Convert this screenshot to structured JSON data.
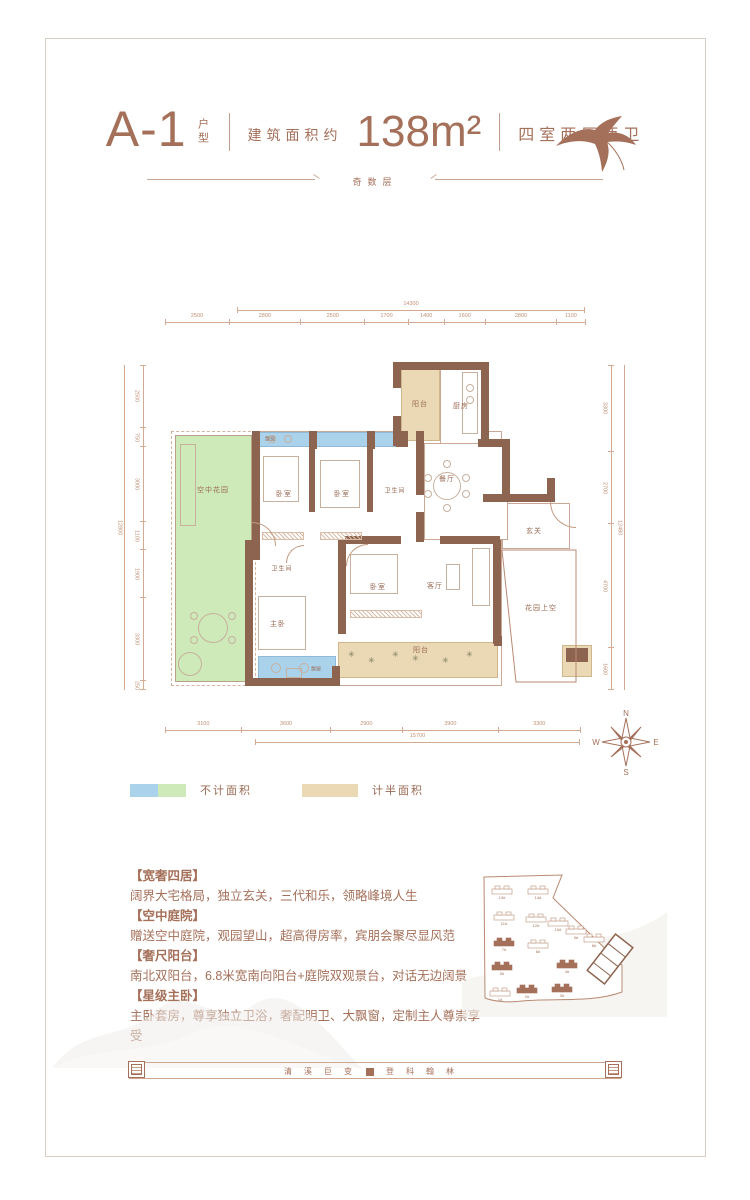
{
  "header": {
    "unit": "A-1",
    "unit_suffix": "户型",
    "area_prefix": "建筑面积约",
    "area": "138m²",
    "layout": "四室两厅两卫",
    "floor_note": "奇数层"
  },
  "floorplan": {
    "rooms": {
      "balcony_top": "阳台",
      "kitchen": "厨房",
      "bedroom_a": "卧室",
      "bedroom_b": "卧室",
      "bath_a": "卫生间",
      "dining": "餐厅",
      "foyer": "玄关",
      "living": "客厅",
      "bedroom_c": "卧室",
      "bath_b": "卫生间",
      "master": "主卧",
      "sky_garden": "空中花园",
      "garden_void": "花园上空",
      "balcony_bottom": "阳台",
      "bay_window_top": "飘窗",
      "bay_window_bottom": "飘窗"
    },
    "dims": {
      "top": {
        "total": "14300",
        "segments": [
          "2500",
          "2800",
          "2500",
          "1700",
          "1400",
          "1600",
          "2800",
          "1100"
        ]
      },
      "bottom": {
        "total": "15700",
        "segments": [
          "3100",
          "3600",
          "2900",
          "3900",
          "3300"
        ]
      },
      "left": {
        "total": "12800",
        "segments": [
          "2500",
          "750",
          "3000",
          "1100",
          "1900",
          "3300",
          "250"
        ]
      },
      "right": {
        "total": "12480",
        "segments": [
          "3300",
          "2700",
          "4700",
          "1600"
        ]
      }
    },
    "colors": {
      "not_counted_blue": "#aad2ea",
      "not_counted_green": "#cdeab8",
      "half_counted": "#ead9b4",
      "wall": "#8d6450"
    }
  },
  "legend": {
    "not_counted": "不计面积",
    "half_counted": "计半面积"
  },
  "compass": {
    "n": "N",
    "e": "E",
    "s": "S",
    "w": "W"
  },
  "features": [
    {
      "title": "【宽奢四居】",
      "desc": "阔界大宅格局，独立玄关，三代和乐，领略峰境人生"
    },
    {
      "title": "【空中庭院】",
      "desc": "赠送空中庭院，观园望山，超高得房率，宾朋会聚尽显风范"
    },
    {
      "title": "【奢尺阳台】",
      "desc": "南北双阳台，6.8米宽南向阳台+庭院双观景台，对话无边阔景"
    },
    {
      "title": "【星级主卧】",
      "desc": "主卧套房，尊享独立卫浴，奢配明卫、大飘窗，定制主人尊崇享受"
    }
  ],
  "siteplan": {
    "buildings": [
      "13#",
      "14#",
      "11#",
      "12#",
      "10#",
      "9#",
      "8#",
      "7#",
      "6#",
      "5#",
      "4#",
      "1#",
      "2#",
      "3#"
    ]
  },
  "footer": {
    "left": "清溪巨变",
    "right": "登科翰林"
  }
}
